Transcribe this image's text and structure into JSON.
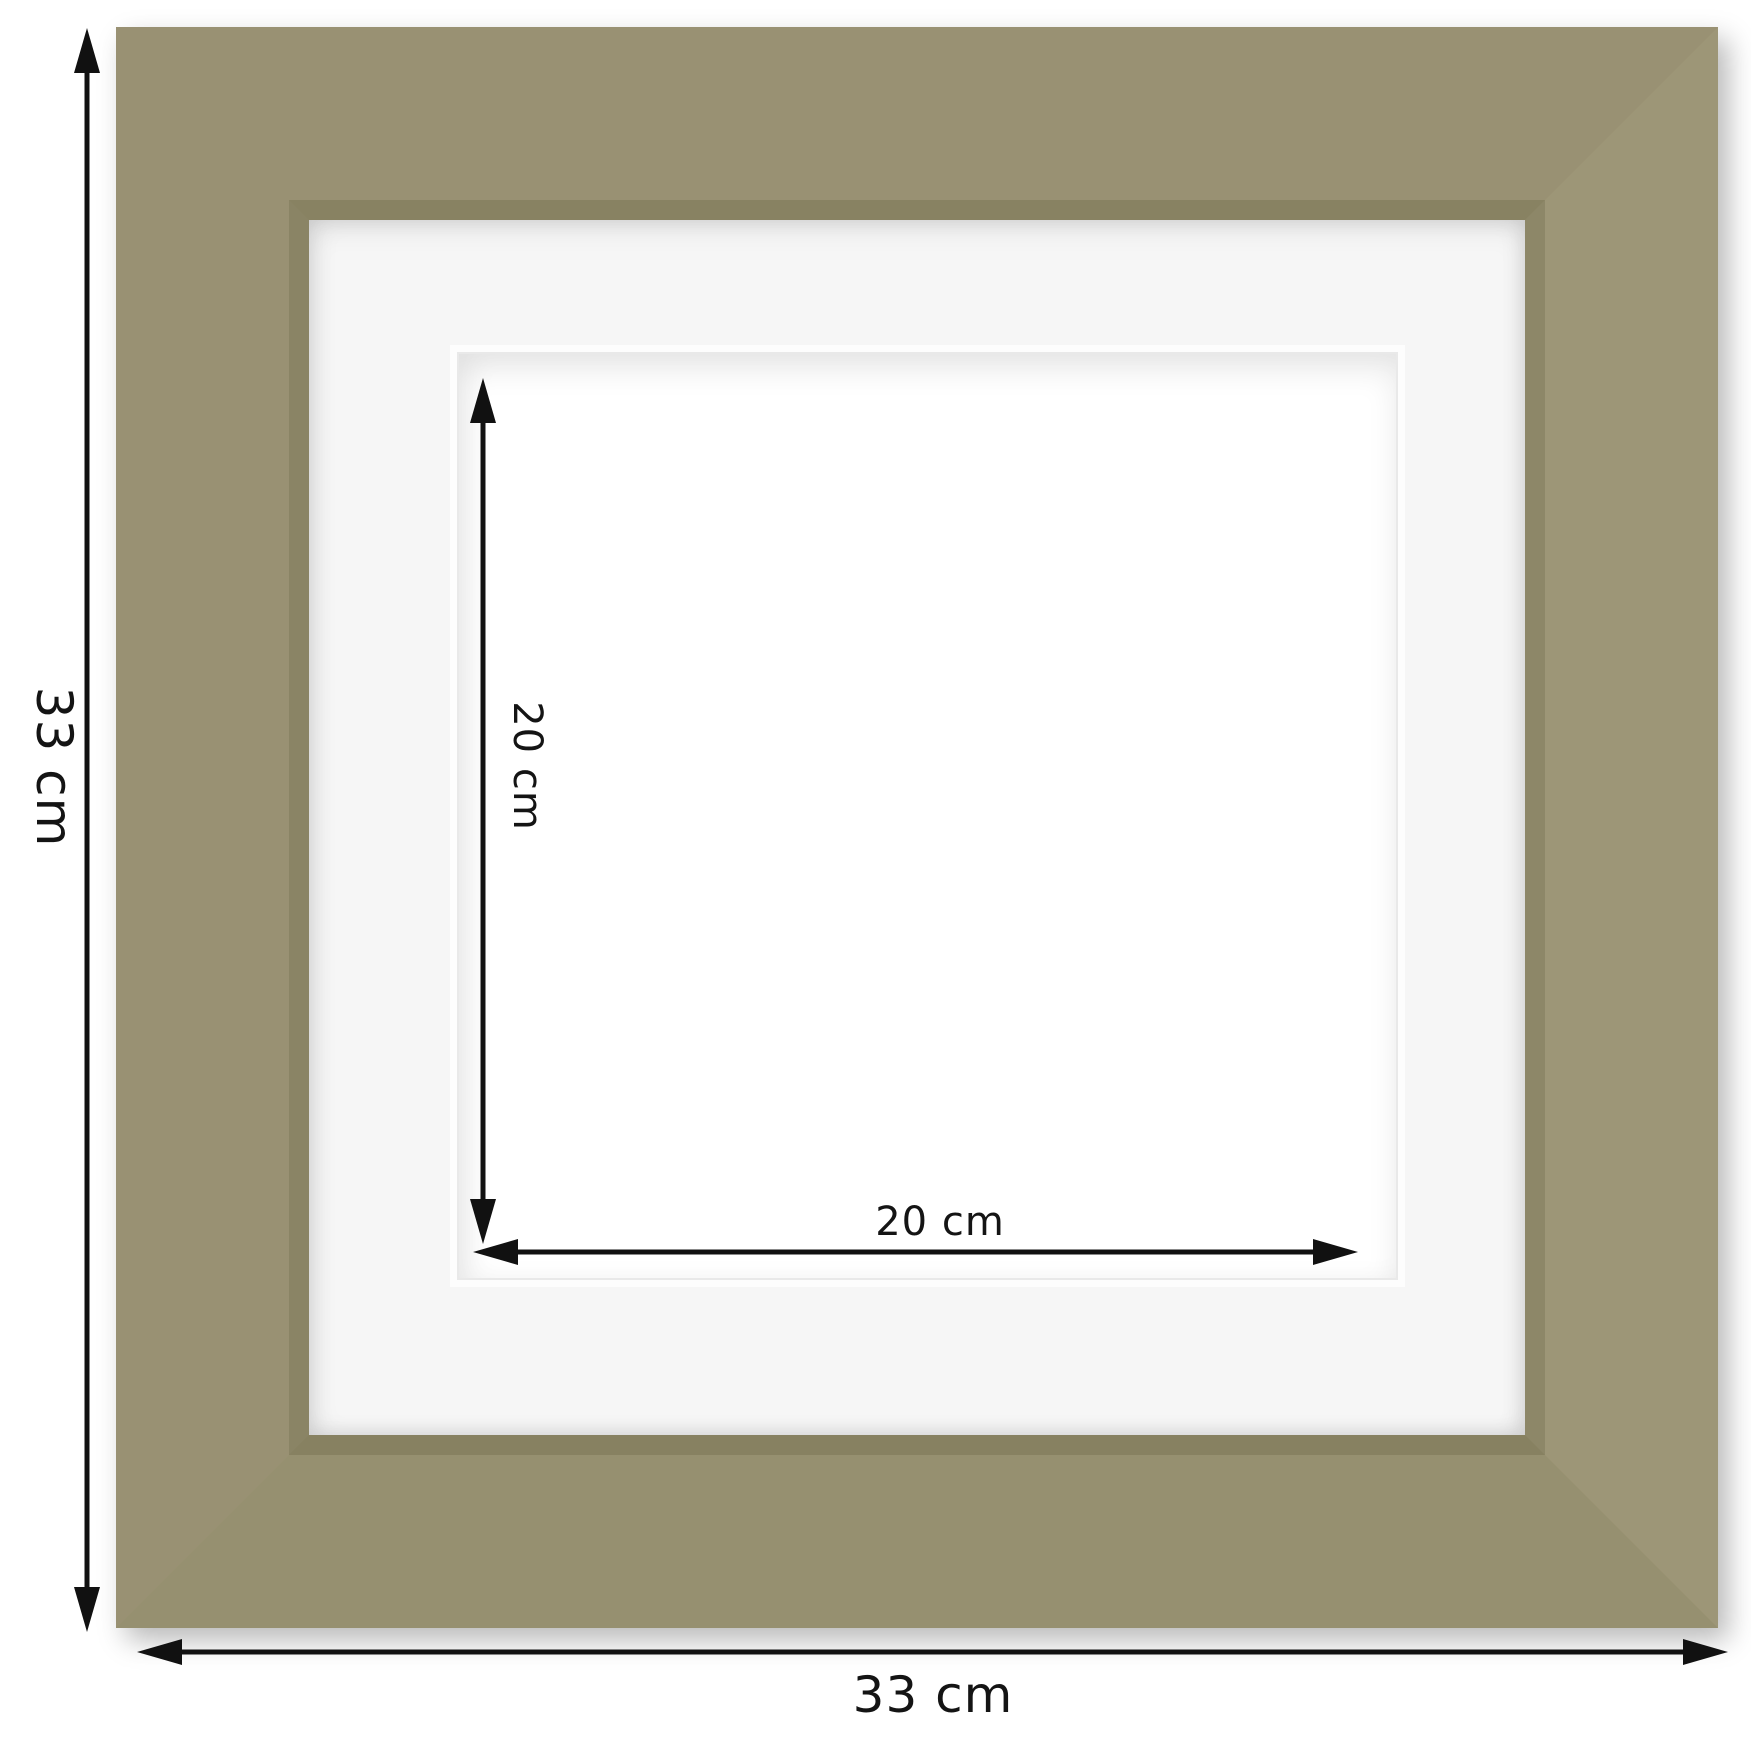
{
  "page": {
    "description": "Square picture frame with white mat - product dimension diagram"
  },
  "colors": {
    "background": "#ffffff",
    "frame_face": "#999173",
    "frame_face_light": "#9d9677",
    "frame_face_dark": "#969070",
    "frame_bevel": "#888262",
    "mat": "#f6f6f6",
    "aperture": "#ffffff",
    "arrow": "#111111",
    "label_text": "#141414"
  },
  "dimensions": {
    "outer_height": {
      "label": "33 cm",
      "arrow_icon": "double-headed-vertical-arrow"
    },
    "outer_width": {
      "label": "33 cm",
      "arrow_icon": "double-headed-horizontal-arrow"
    },
    "inner_height": {
      "label": "20 cm",
      "arrow_icon": "double-headed-vertical-arrow"
    },
    "inner_width": {
      "label": "20 cm",
      "arrow_icon": "double-headed-horizontal-arrow"
    }
  }
}
